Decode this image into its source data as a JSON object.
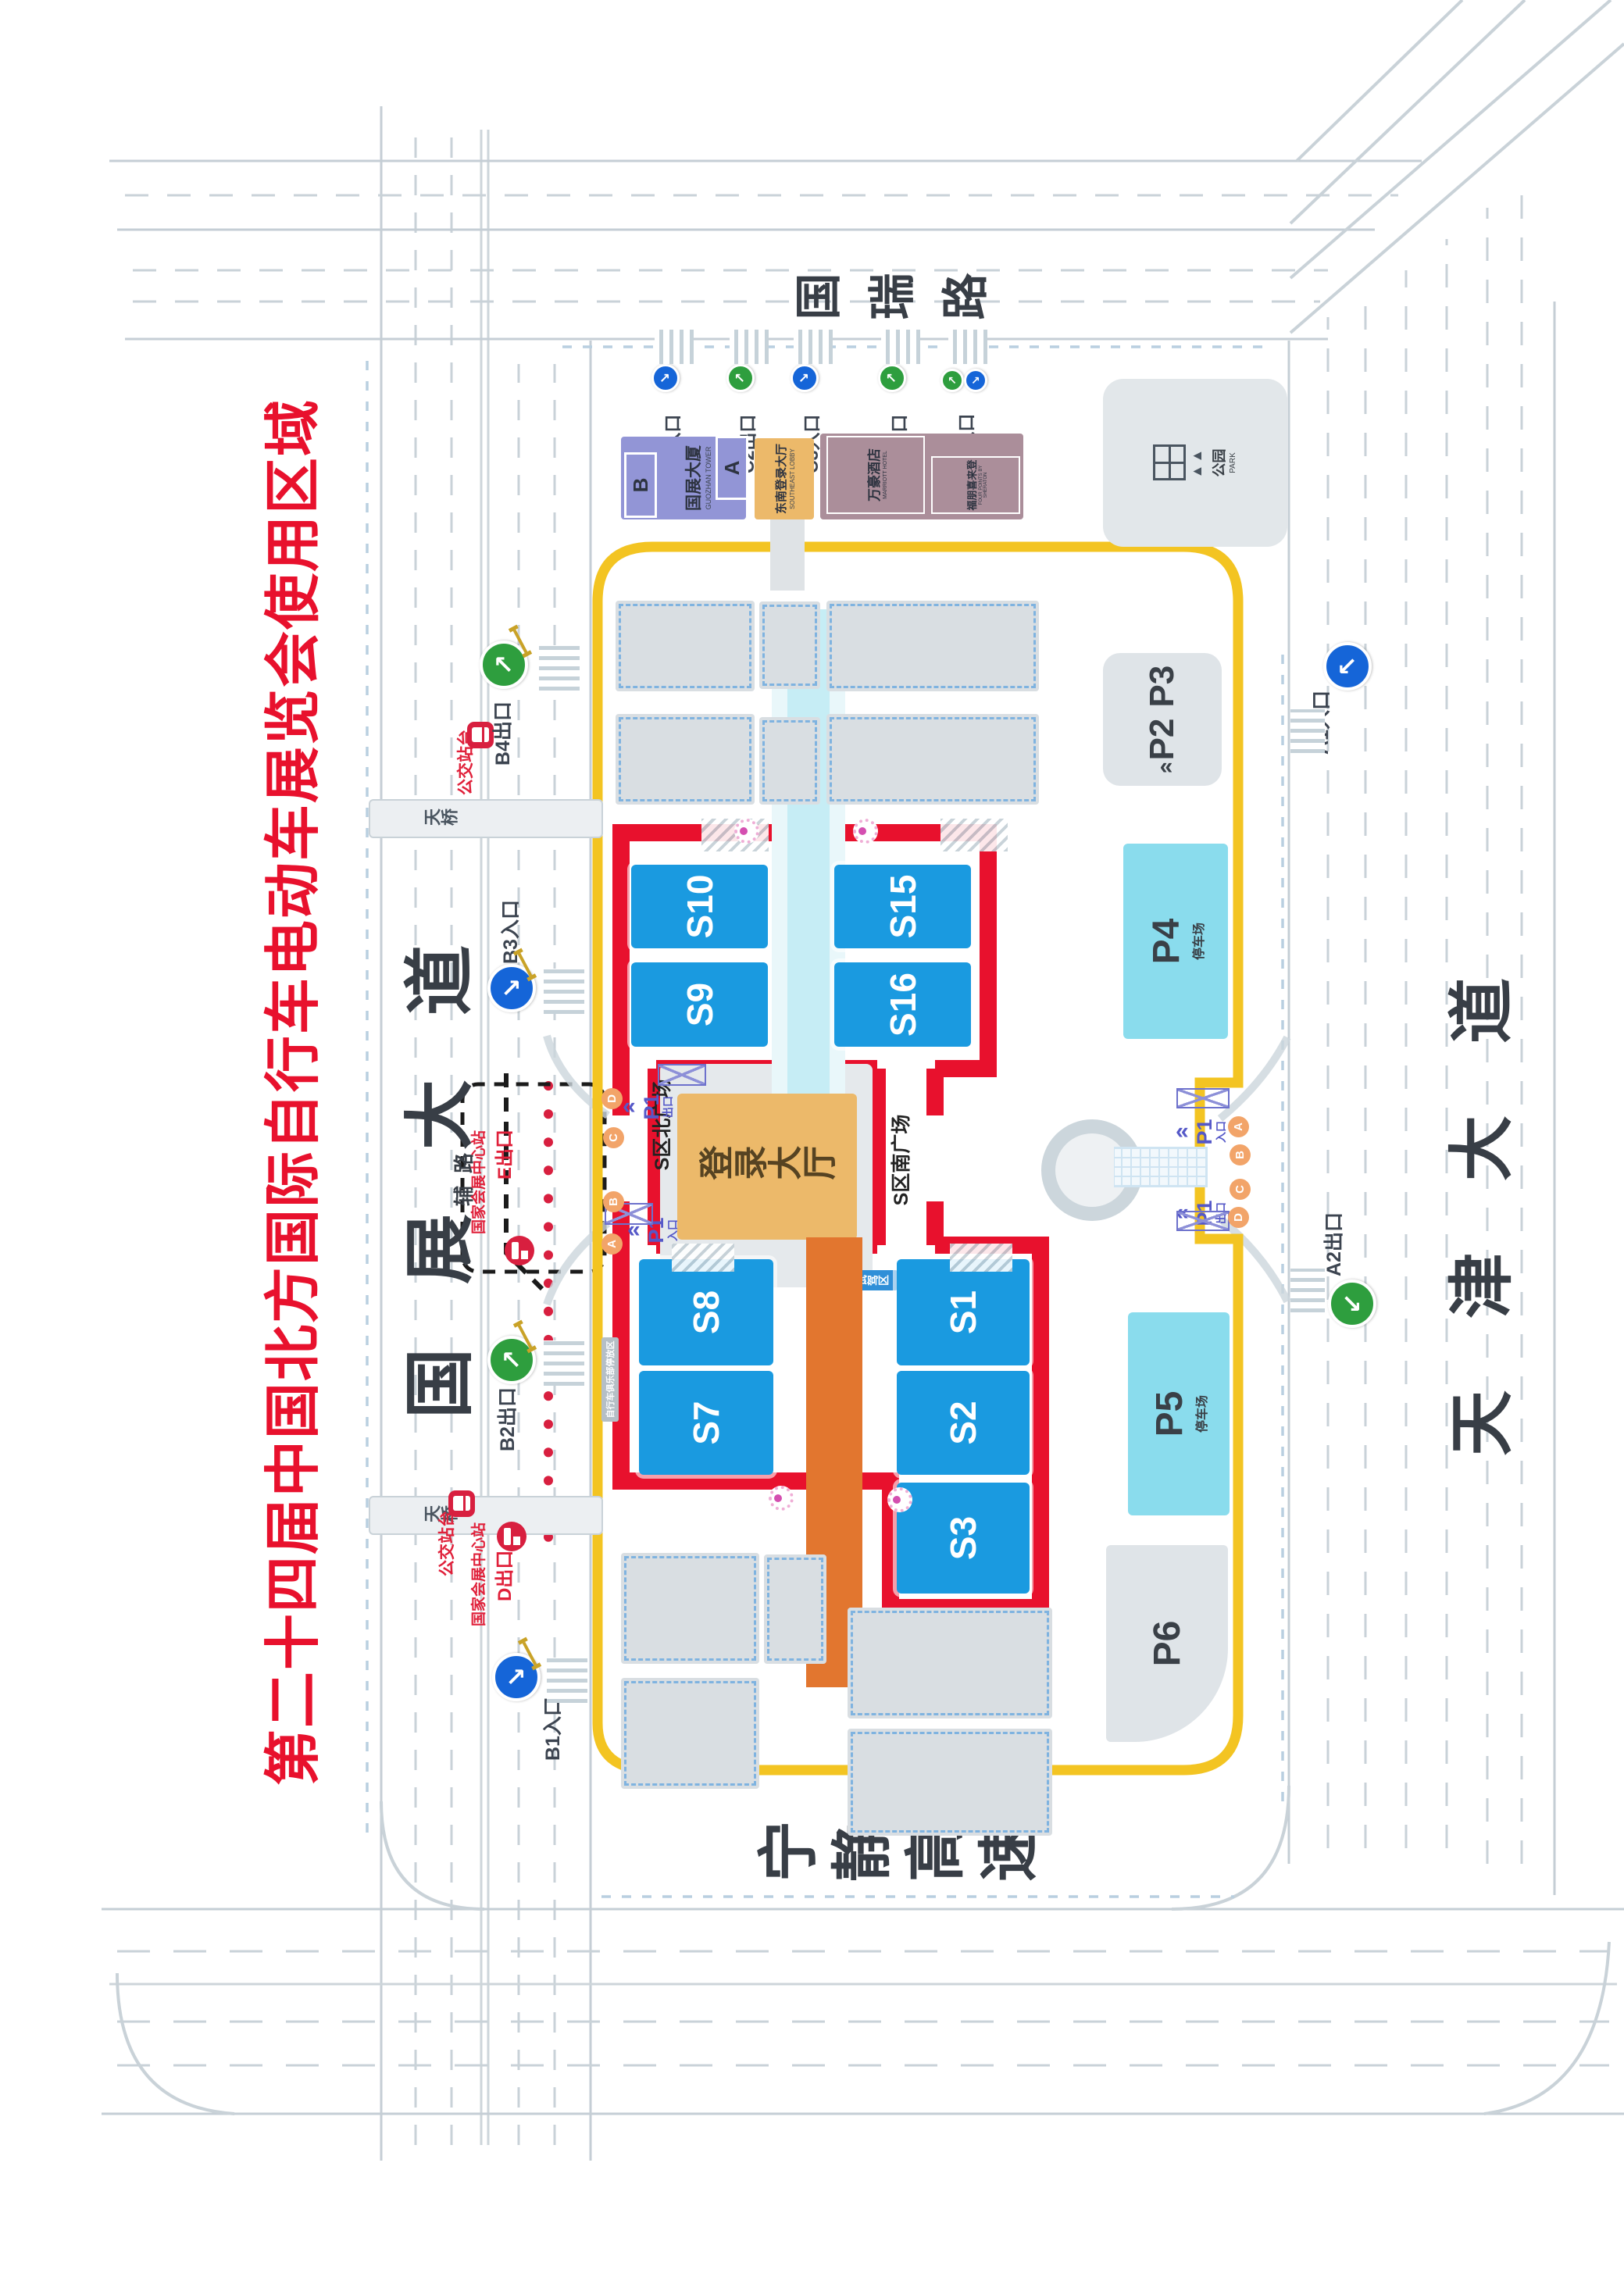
{
  "title": "第二十四届中国北方国际自行车电动车展览会使用区域",
  "roads": {
    "north": "国展大道",
    "service": "辅路",
    "east": "国瑞路",
    "south": "天津大道",
    "west": "宁静高速",
    "bridge": "天桥"
  },
  "gates": {
    "b1": "B1入口",
    "b2": "B2出口",
    "b3": "B3入口",
    "b4": "B4出口",
    "c1": "C1入口",
    "c2": "C2出口",
    "c3": "C3入口",
    "c4": "C4出口",
    "c5": "C5出入口",
    "a1": "A1入口",
    "a2": "A2出口"
  },
  "transit": {
    "bus_stop": "公交站台",
    "metro_station": "国家会展中心站",
    "metro_exit_e": "E出口",
    "metro_exit_d": "D出口"
  },
  "halls": {
    "s1": "S1",
    "s2": "S2",
    "s3": "S3",
    "s7": "S7",
    "s8": "S8",
    "s9": "S9",
    "s10": "S10",
    "s15": "S15",
    "s16": "S16"
  },
  "venue": {
    "registration_hall": "登录大厅",
    "north_plaza": "S区北广场",
    "south_plaza": "S区南广场",
    "test_ride_zone": "试驾区",
    "bike_club_parking": "自行车俱乐部停放区"
  },
  "parking": {
    "p1": "P1",
    "in": "入口",
    "out": "出口",
    "p2": "P2",
    "p3": "P3",
    "p4": "P4",
    "p5": "P5",
    "p6": "P6",
    "lot": "停车场",
    "letters": [
      "A",
      "B",
      "C",
      "D"
    ]
  },
  "buildings": {
    "tower": "国展大厦",
    "tower_en": "GUOZHAN TOWER",
    "tower_a": "A",
    "tower_b": "B",
    "se_lobby": "东南登录大厅",
    "se_lobby_en": "SOUTHEAST LOBBY",
    "hotel_marriott": "万豪酒店",
    "hotel_marriott_en": "MARRIOTT HOTEL",
    "hotel_fourpoints": "福朋喜来登",
    "hotel_fourpoints_en": "FOUR POINTS BY SHERATON",
    "park": "公园",
    "park_en": "PARK"
  },
  "colors": {
    "area_red": "#e8112d",
    "hall_blue": "#1a9ae0",
    "route_yellow": "#f3c422",
    "registration_orange": "#ecb96a",
    "corridor_orange": "#e2762f",
    "corridor_cyan": "#c6edf5",
    "parking_cyan": "#8adced",
    "metro_red": "#d81f3f",
    "p1_purple": "#5558c8",
    "gate_letter_orange": "#f2a469",
    "entrance_blue": "#1565d8",
    "exit_green": "#2e9e3e"
  }
}
